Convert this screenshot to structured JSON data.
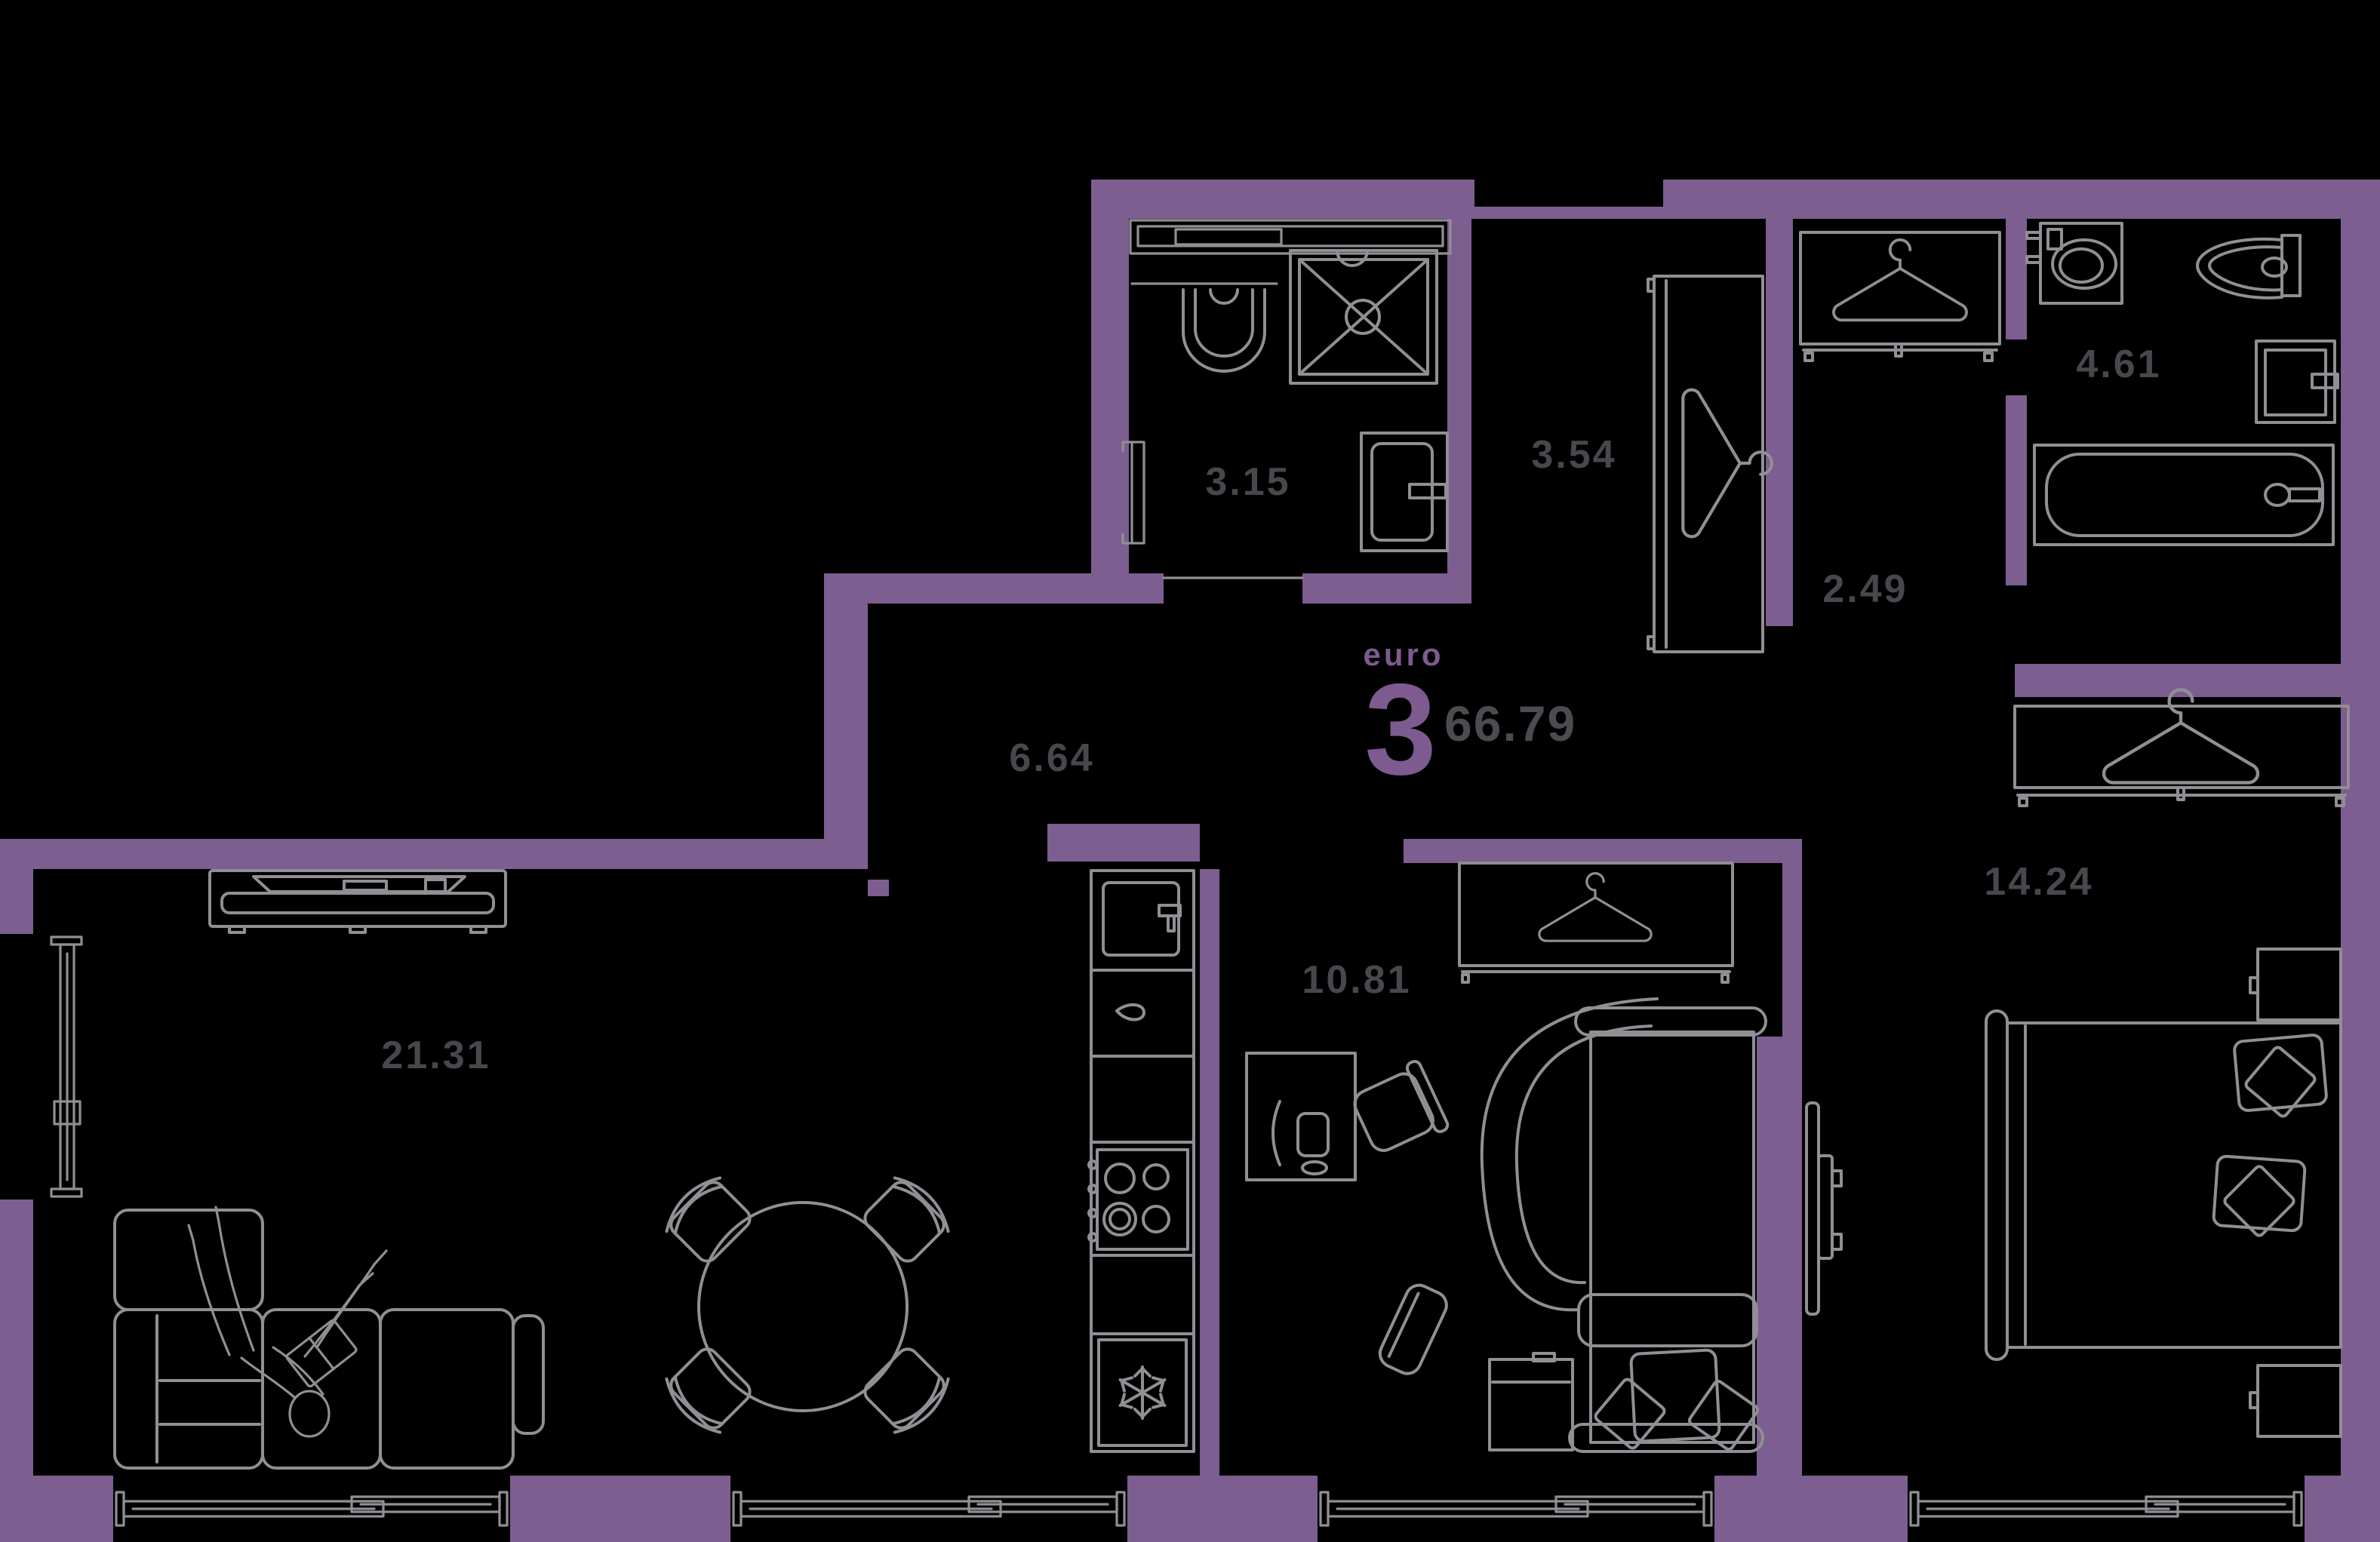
{
  "plan": {
    "type_label": "euro",
    "rooms_count": "3",
    "total_area": "66.79",
    "colors": {
      "background": "#000000",
      "wall": "#7d5e90",
      "furniture_line": "#8f8f94",
      "area_text": "#47474d",
      "accent_text": "#7d5a90",
      "total_text": "#4b4b51"
    },
    "rooms": [
      {
        "id": "bathroom-1",
        "area": "3.15"
      },
      {
        "id": "wardrobe-hall",
        "area": "3.54"
      },
      {
        "id": "corridor",
        "area": "2.49"
      },
      {
        "id": "bathroom-2",
        "area": "4.61"
      },
      {
        "id": "hallway",
        "area": "6.64"
      },
      {
        "id": "living-room",
        "area": "21.31"
      },
      {
        "id": "kids-room",
        "area": "10.81"
      },
      {
        "id": "bedroom",
        "area": "14.24"
      }
    ]
  }
}
